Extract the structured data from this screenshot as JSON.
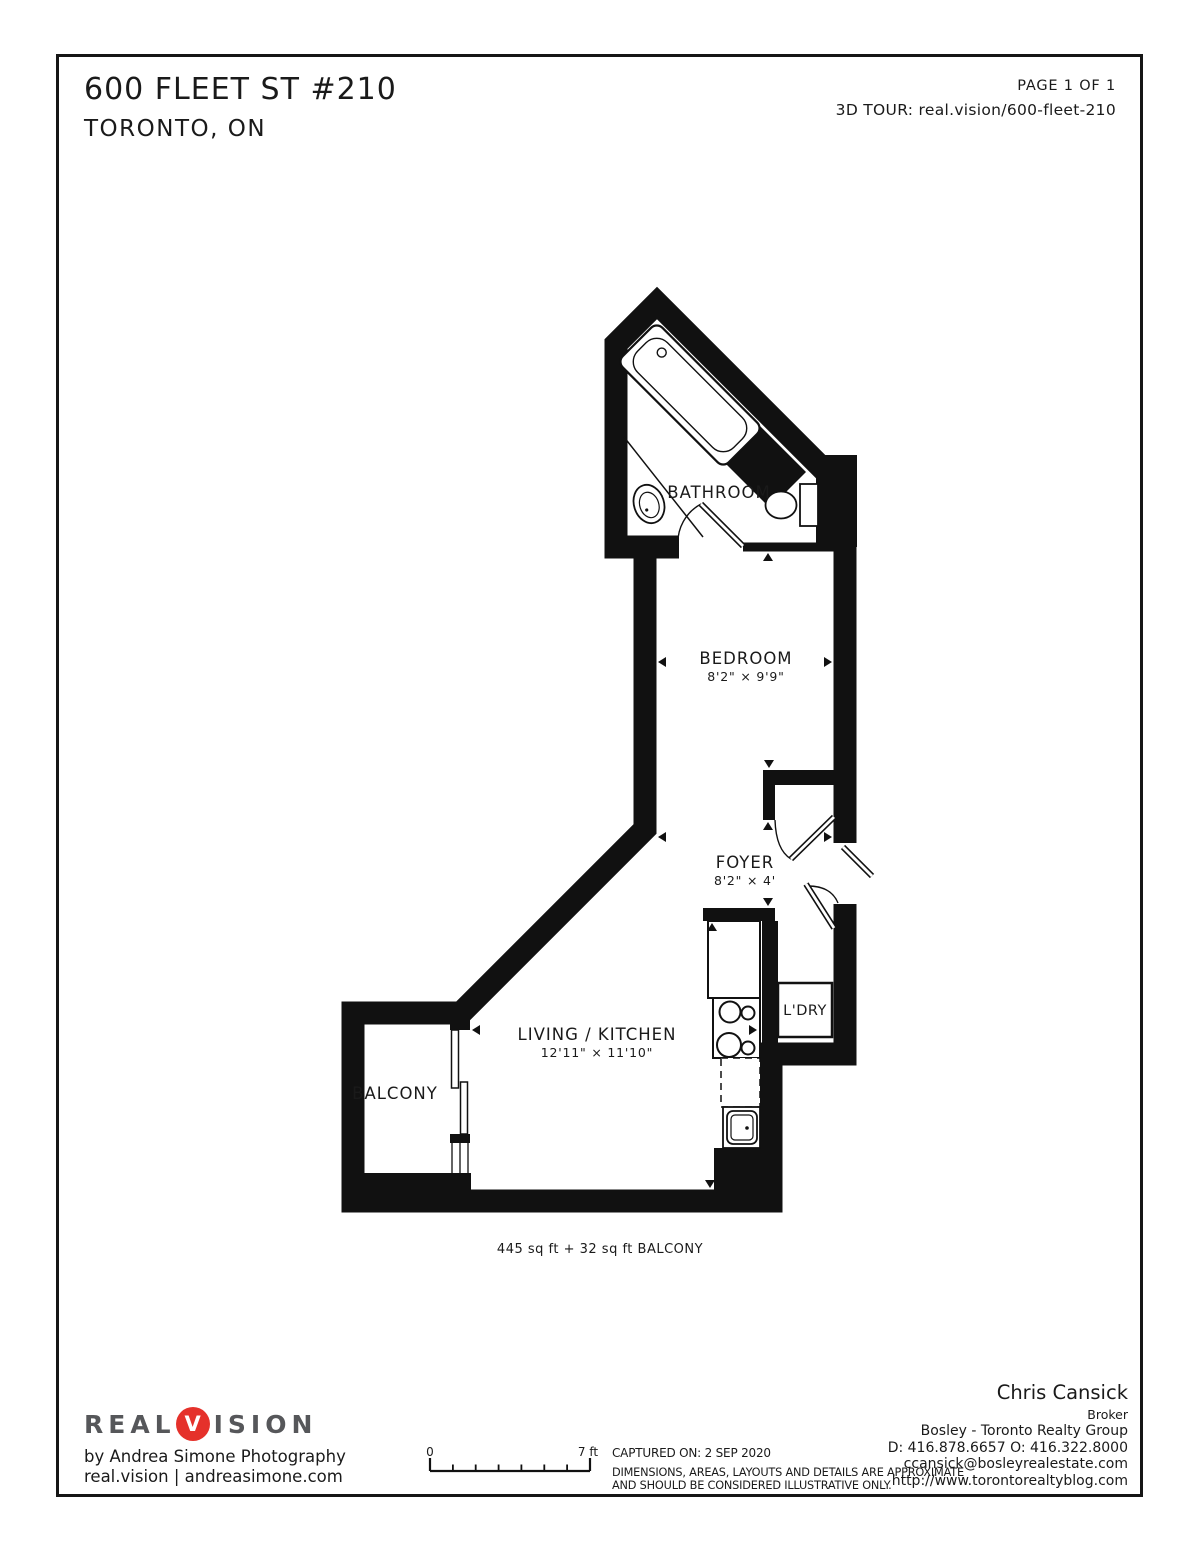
{
  "header": {
    "address_line1": "600 FLEET ST #210",
    "address_line2": "TORONTO, ON",
    "page_label": "PAGE 1 OF 1",
    "tour_label": "3D TOUR: real.vision/600-fleet-210"
  },
  "plan": {
    "rooms": {
      "bathroom": {
        "label": "BATHROOM"
      },
      "bedroom": {
        "label": "BEDROOM",
        "dims": "8'2\" × 9'9\""
      },
      "foyer": {
        "label": "FOYER",
        "dims": "8'2\" × 4'"
      },
      "living_kitchen": {
        "label": "LIVING / KITCHEN",
        "dims": "12'11\" × 11'10\""
      },
      "balcony": {
        "label": "BALCONY"
      },
      "laundry": {
        "label": "L'DRY"
      }
    },
    "area_note": "445 sq ft + 32 sq ft BALCONY",
    "wall_color": "#111111"
  },
  "scale_bar": {
    "start_label": "0",
    "end_label": "7 ft"
  },
  "footer": {
    "brand": {
      "prefix": "REAL",
      "accent_letter": "V",
      "suffix": "ISION",
      "accent_color": "#e5312b",
      "byline": "by Andrea Simone Photography",
      "links": "real.vision | andreasimone.com"
    },
    "captured": "CAPTURED ON: 2 SEP 2020",
    "disclaimer_line1": "DIMENSIONS, AREAS, LAYOUTS AND DETAILS ARE APPROXIMATE",
    "disclaimer_line2": "AND SHOULD BE CONSIDERED ILLUSTRATIVE ONLY.",
    "agent": {
      "name": "Chris Cansick",
      "title": "Broker",
      "company": "Bosley - Toronto Realty Group",
      "phones": "D: 416.878.6657 O: 416.322.8000",
      "email": "ccansick@bosleyrealestate.com",
      "website": "http://www.torontorealtyblog.com"
    }
  }
}
